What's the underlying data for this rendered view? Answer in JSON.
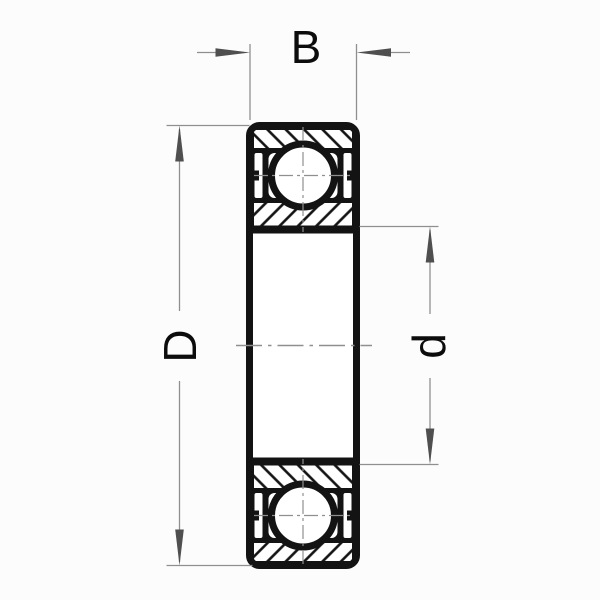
{
  "figure": {
    "kind": "technical-drawing",
    "subject": "ball-bearing-cross-section"
  },
  "dimension_labels": {
    "width": "B",
    "outer_diameter": "D",
    "bore_diameter": "d"
  },
  "colors": {
    "ink": "#131313",
    "dim-line": "#8f8f8f",
    "arrow": "#4f4f4f",
    "label": "#0c0c0c",
    "bg": "#fcfcfc",
    "paper": "#ffffff"
  }
}
